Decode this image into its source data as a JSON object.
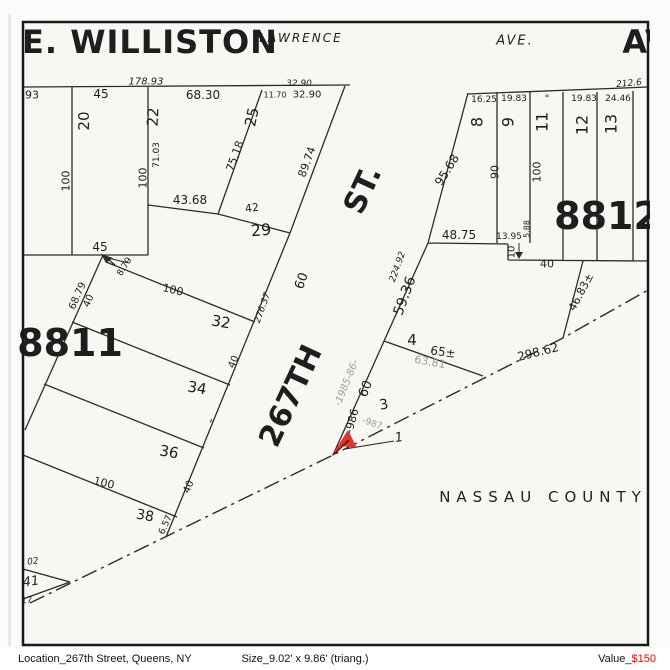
{
  "map": {
    "frame_color": "#1a1a18",
    "line_color": "#2b2b28",
    "paper_color": "#f7f7f4",
    "marker_color": "#e0362b",
    "gray_label_color": "#9c9c98",
    "county_name": "NASSAU COUNTY",
    "blocks": [
      "8811",
      "8812"
    ],
    "streets": [
      "E. WILLISTON",
      "LAWRENCE",
      "AVE.",
      "AV",
      "267TH",
      "ST."
    ],
    "labels": [
      {
        "name": "street-e-williston",
        "t": "E. WILLISTON",
        "x": 150,
        "y": 42,
        "r": 0,
        "fs": 32,
        "cls": "b ls1"
      },
      {
        "name": "street-lawrence",
        "t": "LAWRENCE",
        "x": 301,
        "y": 38,
        "r": 0,
        "fs": 12,
        "cls": "i ls2"
      },
      {
        "name": "street-ave",
        "t": "AVE.",
        "x": 515,
        "y": 41,
        "r": 0,
        "fs": 13,
        "cls": "i ls2"
      },
      {
        "name": "street-av-clipped",
        "t": "AV",
        "x": 646,
        "y": 42,
        "r": 0,
        "fs": 32,
        "cls": "b"
      },
      {
        "name": "street-st",
        "t": "ST.",
        "x": 363,
        "y": 190,
        "r": -65,
        "fs": 30,
        "cls": "b"
      },
      {
        "name": "street-267th",
        "t": "267TH",
        "x": 291,
        "y": 396,
        "r": -65,
        "fs": 30,
        "cls": "b"
      },
      {
        "name": "block-8811",
        "t": "8811",
        "x": 70,
        "y": 343,
        "r": 0,
        "fs": 38,
        "cls": "b"
      },
      {
        "name": "block-8812",
        "t": "8812",
        "x": 607,
        "y": 216,
        "r": 0,
        "fs": 38,
        "cls": "b"
      },
      {
        "name": "nassau-county",
        "t": "NASSAU COUNTY",
        "x": 543,
        "y": 497,
        "r": 0,
        "fs": 15,
        "cls": "ls6"
      },
      {
        "name": "dim-93",
        "t": "93",
        "x": 32,
        "y": 95,
        "r": 0,
        "fs": 11,
        "cls": ""
      },
      {
        "name": "dim-178-93",
        "t": "178.93",
        "x": 146,
        "y": 82,
        "r": 0,
        "fs": 10,
        "cls": "i"
      },
      {
        "name": "lot20-frontage-45",
        "t": "45",
        "x": 101,
        "y": 94,
        "r": 0,
        "fs": 12,
        "cls": ""
      },
      {
        "name": "dim-68-30",
        "t": "68.30",
        "x": 203,
        "y": 95,
        "r": 0,
        "fs": 12,
        "cls": ""
      },
      {
        "name": "dim-32-90-italic",
        "t": "32.90",
        "x": 299,
        "y": 84,
        "r": 0,
        "fs": 9,
        "cls": "i"
      },
      {
        "name": "dim-11-70",
        "t": "11.70",
        "x": 275,
        "y": 95,
        "r": 0,
        "fs": 8,
        "cls": ""
      },
      {
        "name": "dim-32-90",
        "t": "32.90",
        "x": 307,
        "y": 95,
        "r": 0,
        "fs": 10,
        "cls": ""
      },
      {
        "name": "lot-20",
        "t": "20",
        "x": 84,
        "y": 121,
        "r": -90,
        "fs": 15,
        "cls": ""
      },
      {
        "name": "lot-22",
        "t": "22",
        "x": 153,
        "y": 117,
        "r": -87,
        "fs": 15,
        "cls": ""
      },
      {
        "name": "lot-25",
        "t": "25",
        "x": 252,
        "y": 117,
        "r": -78,
        "fs": 15,
        "cls": ""
      },
      {
        "name": "dim-100-a",
        "t": "100",
        "x": 66,
        "y": 181,
        "r": -90,
        "fs": 11,
        "cls": ""
      },
      {
        "name": "dim-100-b",
        "t": "100",
        "x": 143,
        "y": 178,
        "r": -90,
        "fs": 11,
        "cls": ""
      },
      {
        "name": "dim-71-03",
        "t": "71.03",
        "x": 157,
        "y": 155,
        "r": -90,
        "fs": 9,
        "cls": ""
      },
      {
        "name": "dim-43-68",
        "t": "43.68",
        "x": 190,
        "y": 200,
        "r": 0,
        "fs": 12,
        "cls": ""
      },
      {
        "name": "dim-42",
        "t": "42",
        "x": 252,
        "y": 208,
        "r": -8,
        "fs": 11,
        "cls": ""
      },
      {
        "name": "lot-29",
        "t": "29",
        "x": 261,
        "y": 230,
        "r": -5,
        "fs": 16,
        "cls": ""
      },
      {
        "name": "dim-75-18",
        "t": "75.18",
        "x": 235,
        "y": 156,
        "r": -70,
        "fs": 11,
        "cls": ""
      },
      {
        "name": "dim-89-74",
        "t": "89.74",
        "x": 307,
        "y": 162,
        "r": -70,
        "fs": 11,
        "cls": ""
      },
      {
        "name": "lot20-rear-45",
        "t": "45",
        "x": 100,
        "y": 247,
        "r": 0,
        "fs": 12,
        "cls": ""
      },
      {
        "name": "dim-8-79",
        "t": "8.79",
        "x": 125,
        "y": 267,
        "r": -58,
        "fs": 9,
        "cls": ""
      },
      {
        "name": "dim-68-79",
        "t": "68.79",
        "x": 78,
        "y": 296,
        "r": -66,
        "fs": 10,
        "cls": ""
      },
      {
        "name": "dim-40-a",
        "t": "40",
        "x": 89,
        "y": 301,
        "r": -66,
        "fs": 10,
        "cls": ""
      },
      {
        "name": "dim-100-c",
        "t": "100",
        "x": 173,
        "y": 290,
        "r": 13,
        "fs": 11,
        "cls": ""
      },
      {
        "name": "lot-32",
        "t": "32",
        "x": 221,
        "y": 322,
        "r": 10,
        "fs": 15,
        "cls": ""
      },
      {
        "name": "lot-34",
        "t": "34",
        "x": 197,
        "y": 388,
        "r": 10,
        "fs": 15,
        "cls": ""
      },
      {
        "name": "dim-40-b",
        "t": "40",
        "x": 234,
        "y": 362,
        "r": -66,
        "fs": 10,
        "cls": ""
      },
      {
        "name": "ditto-lot36",
        "t": "\"",
        "x": 211,
        "y": 424,
        "r": 20,
        "fs": 12,
        "cls": ""
      },
      {
        "name": "lot-36",
        "t": "36",
        "x": 169,
        "y": 452,
        "r": 10,
        "fs": 15,
        "cls": ""
      },
      {
        "name": "dim-100-d",
        "t": "100",
        "x": 104,
        "y": 483,
        "r": 13,
        "fs": 11,
        "cls": ""
      },
      {
        "name": "lot-38",
        "t": "38",
        "x": 145,
        "y": 516,
        "r": 10,
        "fs": 14,
        "cls": ""
      },
      {
        "name": "dim-40-c",
        "t": "40",
        "x": 189,
        "y": 487,
        "r": -66,
        "fs": 10,
        "cls": ""
      },
      {
        "name": "dim-6-57",
        "t": "6.57",
        "x": 166,
        "y": 525,
        "r": -66,
        "fs": 9,
        "cls": ""
      },
      {
        "name": "dim-02",
        "t": "02",
        "x": 33,
        "y": 562,
        "r": -8,
        "fs": 9,
        "cls": "i"
      },
      {
        "name": "lot-41",
        "t": "41",
        "x": 31,
        "y": 582,
        "r": -8,
        "fs": 13,
        "cls": "i"
      },
      {
        "name": "dim-17",
        "t": "17",
        "x": 27,
        "y": 601,
        "r": -8,
        "fs": 9,
        "cls": "i"
      },
      {
        "name": "dim-95-68",
        "t": "95.68",
        "x": 447,
        "y": 170,
        "r": -58,
        "fs": 12,
        "cls": ""
      },
      {
        "name": "dim-16-25",
        "t": "16.25",
        "x": 484,
        "y": 100,
        "r": 0,
        "fs": 9,
        "cls": ""
      },
      {
        "name": "dim-19-83-a",
        "t": "19.83",
        "x": 514,
        "y": 99,
        "r": 0,
        "fs": 9,
        "cls": ""
      },
      {
        "name": "ditto-lot11",
        "t": "\"",
        "x": 547,
        "y": 99,
        "r": 0,
        "fs": 10,
        "cls": ""
      },
      {
        "name": "dim-19-83-b",
        "t": "19.83",
        "x": 584,
        "y": 99,
        "r": 0,
        "fs": 9,
        "cls": ""
      },
      {
        "name": "dim-24-46",
        "t": "24.46",
        "x": 618,
        "y": 99,
        "r": 0,
        "fs": 9,
        "cls": ""
      },
      {
        "name": "dim-212-6",
        "t": "212.6",
        "x": 629,
        "y": 84,
        "r": -5,
        "fs": 9,
        "cls": "i"
      },
      {
        "name": "lot-8",
        "t": "8",
        "x": 477,
        "y": 122,
        "r": -90,
        "fs": 16,
        "cls": ""
      },
      {
        "name": "lot-9",
        "t": "9",
        "x": 508,
        "y": 122,
        "r": -90,
        "fs": 16,
        "cls": ""
      },
      {
        "name": "lot-11",
        "t": "11",
        "x": 542,
        "y": 122,
        "r": -90,
        "fs": 16,
        "cls": ""
      },
      {
        "name": "lot-12",
        "t": "12",
        "x": 582,
        "y": 125,
        "r": -90,
        "fs": 16,
        "cls": ""
      },
      {
        "name": "lot-13",
        "t": "13",
        "x": 611,
        "y": 124,
        "r": -90,
        "fs": 16,
        "cls": ""
      },
      {
        "name": "dim-90",
        "t": "90",
        "x": 495,
        "y": 172,
        "r": -90,
        "fs": 11,
        "cls": ""
      },
      {
        "name": "dim-100-e",
        "t": "100",
        "x": 537,
        "y": 172,
        "r": -90,
        "fs": 11,
        "cls": ""
      },
      {
        "name": "dim-48-75",
        "t": "48.75",
        "x": 459,
        "y": 235,
        "r": 0,
        "fs": 12,
        "cls": ""
      },
      {
        "name": "dim-13-95",
        "t": "13.95",
        "x": 509,
        "y": 237,
        "r": 0,
        "fs": 9,
        "cls": ""
      },
      {
        "name": "dim-5-88",
        "t": "5.88",
        "x": 527,
        "y": 229,
        "r": -90,
        "fs": 8,
        "cls": ""
      },
      {
        "name": "dim-10",
        "t": "10",
        "x": 512,
        "y": 252,
        "r": -90,
        "fs": 10,
        "cls": ""
      },
      {
        "name": "dim-40-d",
        "t": "40",
        "x": 547,
        "y": 264,
        "r": 0,
        "fs": 11,
        "cls": ""
      },
      {
        "name": "dim-60-upper",
        "t": "60",
        "x": 302,
        "y": 281,
        "r": -70,
        "fs": 13,
        "cls": ""
      },
      {
        "name": "dim-276-37",
        "t": "276.37",
        "x": 263,
        "y": 308,
        "r": -70,
        "fs": 9,
        "cls": "i"
      },
      {
        "name": "dim-224-92",
        "t": "224.92",
        "x": 398,
        "y": 267,
        "r": -70,
        "fs": 9,
        "cls": "i"
      },
      {
        "name": "dim-59-36",
        "t": "59.36",
        "x": 405,
        "y": 296,
        "r": -70,
        "fs": 14,
        "cls": ""
      },
      {
        "name": "lot-4",
        "t": "4",
        "x": 412,
        "y": 340,
        "r": 0,
        "fs": 15,
        "cls": ""
      },
      {
        "name": "dim-65-plusminus",
        "t": "65±",
        "x": 443,
        "y": 352,
        "r": 8,
        "fs": 12,
        "cls": ""
      },
      {
        "name": "dim-63-81",
        "t": "63.81",
        "x": 430,
        "y": 362,
        "r": 10,
        "fs": 11,
        "cls": "g"
      },
      {
        "name": "note-1985-86",
        "t": "-1985-86-",
        "x": 347,
        "y": 383,
        "r": -68,
        "fs": 10,
        "cls": "g i"
      },
      {
        "name": "dim-60-lower",
        "t": "60",
        "x": 366,
        "y": 389,
        "r": -68,
        "fs": 13,
        "cls": ""
      },
      {
        "name": "lot-3",
        "t": "3",
        "x": 384,
        "y": 405,
        "r": -10,
        "fs": 14,
        "cls": ""
      },
      {
        "name": "old-lot-986",
        "t": "-986",
        "x": 352,
        "y": 421,
        "r": -75,
        "fs": 11,
        "cls": ""
      },
      {
        "name": "old-lot-987",
        "t": "-987",
        "x": 372,
        "y": 424,
        "r": 20,
        "fs": 9,
        "cls": "g"
      },
      {
        "name": "lot-1",
        "t": "1",
        "x": 399,
        "y": 438,
        "r": -8,
        "fs": 13,
        "cls": "i"
      },
      {
        "name": "dim-298-62",
        "t": "298.62",
        "x": 538,
        "y": 352,
        "r": -14,
        "fs": 12,
        "cls": ""
      },
      {
        "name": "dim-46-83",
        "t": "46.83±",
        "x": 581,
        "y": 292,
        "r": -62,
        "fs": 11,
        "cls": ""
      }
    ]
  },
  "caption": {
    "location": "Location_267th Street, Queens, NY",
    "size": "Size_9.02' x 9.86' (triang.)",
    "value_label": "Value_",
    "value_amount": "$150",
    "value_color": "#ff0000"
  }
}
